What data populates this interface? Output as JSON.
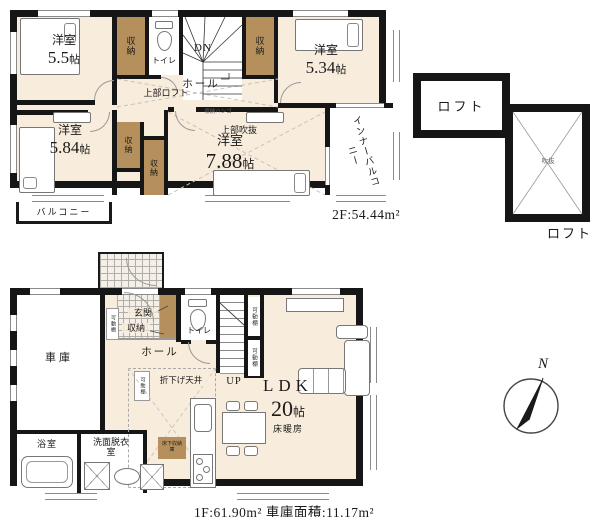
{
  "floor2": {
    "bedrooms": [
      {
        "name": "洋室",
        "num": "5.5",
        "unit": "帖"
      },
      {
        "name": "洋室",
        "num": "5.34",
        "unit": "帖"
      },
      {
        "name": "洋室",
        "num": "5.84",
        "unit": "帖"
      },
      {
        "name": "洋室",
        "num": "7.88",
        "unit": "帖"
      }
    ],
    "closet": "収納",
    "toilet": "トイレ",
    "stairs_down": "DN",
    "hall": "ホール",
    "upper_loft": "上部ロフト",
    "upper_void": "上部吹抜",
    "storage_ladder": "収納ハシゴ",
    "inner_balcony": "インナーバルコニー",
    "balcony": "バルコニー",
    "area_caption": "2F:54.44m²"
  },
  "loft": {
    "room": "ロフト",
    "void": "吹抜",
    "caption": "ロフト"
  },
  "floor1": {
    "garage": "車庫",
    "entrance": "玄関",
    "entrance_storage": "収納",
    "movable_shelf": "可動棚",
    "toilet": "トイレ",
    "stairs_up": "UP",
    "hall": "ホール",
    "lowered_ceiling": "折下げ天井",
    "ldk_name": "LDK",
    "ldk_num": "20",
    "ldk_unit": "帖",
    "floor_heating": "床暖房",
    "bathroom": "浴室",
    "washroom": "洗面脱衣室",
    "underfloor_storage": "床下収納庫",
    "area_caption": "1F:61.90m² 車庫面積:11.17m²"
  },
  "compass": {
    "north": "N"
  },
  "colors": {
    "wall": "#161616",
    "floor": "#f8ecdc",
    "closet": "#b6905c"
  }
}
